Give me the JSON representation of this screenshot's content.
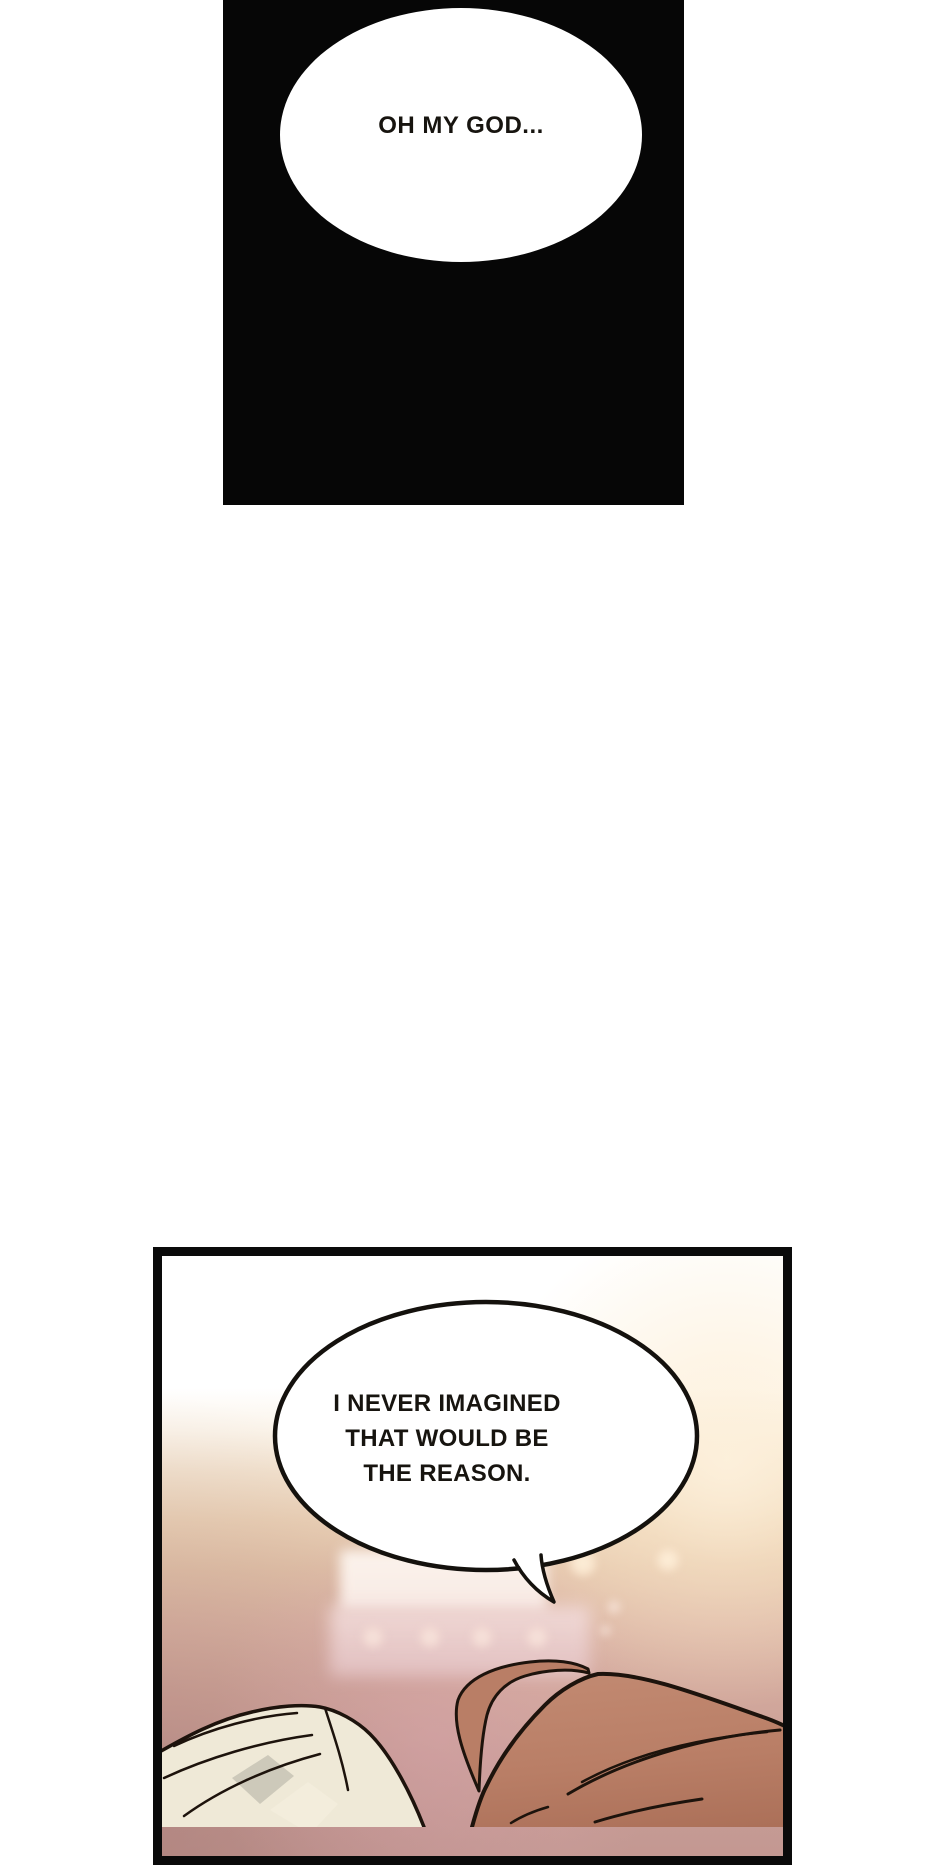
{
  "top_panel": {
    "bubble_text": "OH MY GOD..."
  },
  "bottom_panel": {
    "bubble_lines": [
      "I NEVER IMAGINED",
      "THAT WOULD BE",
      "THE REASON."
    ]
  },
  "scene": {
    "elements": [
      "stage-screen-glow",
      "stage-light-dots",
      "bokeh-glow-lights",
      "auburn-hair",
      "clasped-hands"
    ]
  },
  "colors": {
    "page_bg": "#ffffff",
    "panel_black": "#060606",
    "border_ink": "#0a0a0a",
    "ink": "#17140f",
    "bubble_fill": "#ffffff",
    "bubble_stroke": "#14110d",
    "outline": "#1d130c",
    "hair": "#b97e66",
    "hair_light": "#c28a72",
    "hair_dark": "#a76b54",
    "hands": "#efe9d7",
    "hands_shadow": "#cdc9ba",
    "hands_highlight": "#f3eddc",
    "glow": "#fdf0da",
    "screen_top": "#fbf3ec",
    "screen_bottom": "#f8eae4",
    "pink_band": "#eed7d4",
    "dot": "#f8e6de"
  }
}
